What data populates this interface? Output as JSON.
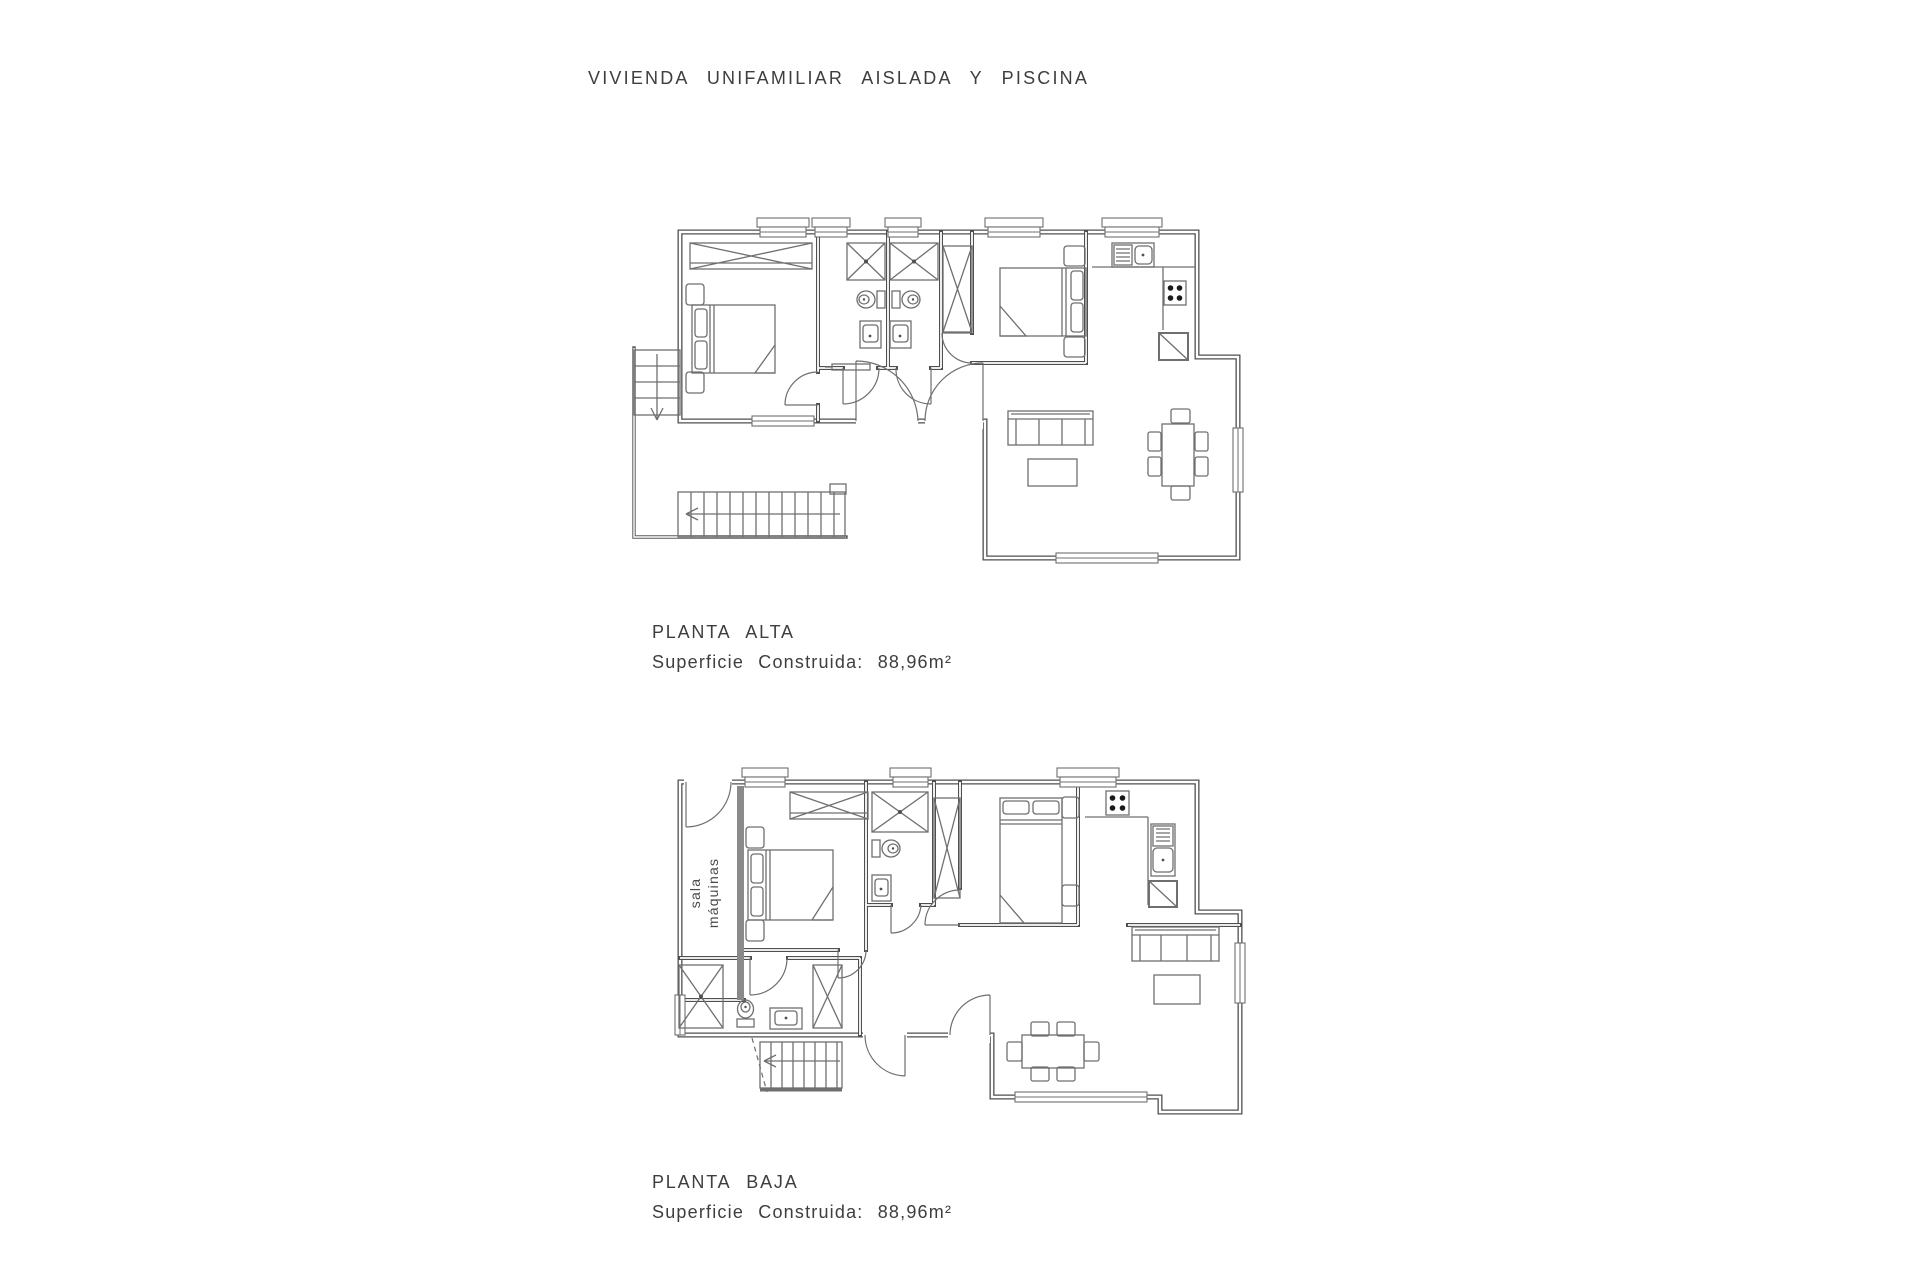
{
  "title": "VIVIENDA UNIFAMILIAR AISLADA Y PISCINA",
  "colors": {
    "background": "#ffffff",
    "wall_line": "#4f4f4f",
    "furniture_line": "#6f6f6f",
    "text": "#3e3e3e"
  },
  "plans": [
    {
      "id": "planta-alta",
      "name": "PLANTA ALTA",
      "area_label": "Superficie Construida:",
      "area_value": "88,96m²"
    },
    {
      "id": "planta-baja",
      "name": "PLANTA BAJA",
      "area_label": "Superficie Construida:",
      "area_value": "88,96m²",
      "machine_room": [
        "sala",
        "máquinas"
      ]
    }
  ]
}
